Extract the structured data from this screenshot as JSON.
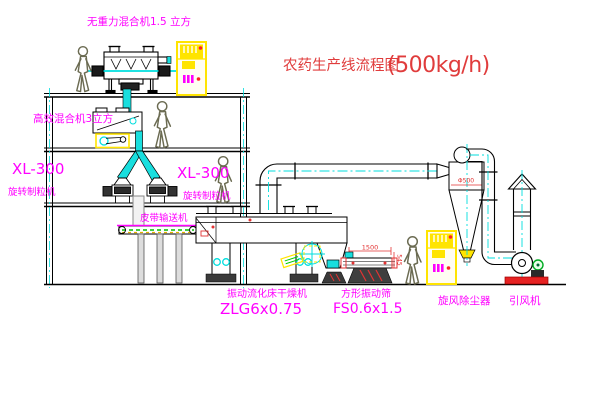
{
  "title": {
    "zh": "农药生产线流程图",
    "capacity": "(500kg/h)"
  },
  "labels": {
    "top_mixer": "无重力混合机1.5 立方",
    "floor2_mixer": "高效混合机3立方",
    "granulator_left_model": "XL-300",
    "granulator_left_name": "旋转制粒机",
    "granulator_mid_model": "XL-300",
    "granulator_mid_name": "旋转制粒机",
    "belt_conveyor": "皮带输送机",
    "dryer_name": "振动流化床干燥机",
    "dryer_model": "ZLG6x0.75",
    "screen_name": "方形振动筛",
    "screen_model": "FS0.6x1.5",
    "cyclone_name": "旋风除尘器",
    "fan_name": "引风机"
  },
  "dimensions": {
    "cyclone_inlet": "Φ500",
    "screen_length": "1500",
    "screen_height": "545"
  },
  "colors": {
    "label_magenta": "#ff00ff",
    "title_red": "#e03c3c",
    "dimension_red": "#e33333",
    "pipe_cyan": "#00dede",
    "cabinet_yellow": "#ffe400",
    "motor_green": "#00aa22",
    "line_black": "#000000"
  }
}
